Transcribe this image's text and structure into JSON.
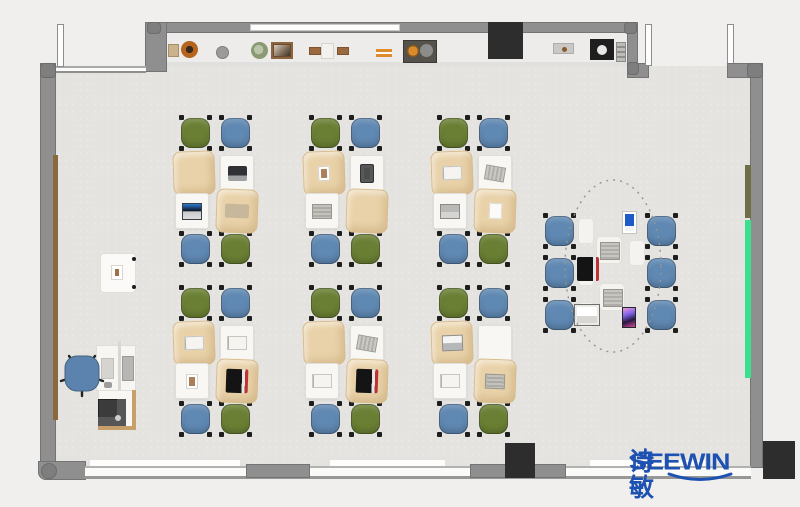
{
  "brand": {
    "name": "SEEWIN",
    "cjk": "诗敏",
    "color": "#1d51b2"
  },
  "palette": {
    "bg": "#f0efed",
    "floor": "#e4e3e0",
    "alcove": "#edecea",
    "wall": "#8f8f8f",
    "wallDark": "#747474",
    "column": "#2d2d2d",
    "tan": "#e9d2a9",
    "tanDark": "#d7bb8c",
    "deskWhite": "#f8f7f4",
    "deskBorder": "#e0ded8",
    "green": "#6a7f33",
    "blue": "#5f88b2",
    "foot": "#1e1e1e",
    "wood": "#8a6a3c",
    "olive": "#6e6e49",
    "neon": "#3ce08c",
    "pad": "#f4f3f0",
    "brand": "#1d51b2"
  },
  "classroom": {
    "cluster_chair_layout": [
      {
        "dx": 6,
        "dy": 0,
        "color": "green"
      },
      {
        "dx": 46,
        "dy": 0,
        "color": "blue"
      },
      {
        "dx": 6,
        "dy": 116,
        "color": "blue"
      },
      {
        "dx": 46,
        "dy": 116,
        "color": "green"
      }
    ],
    "cluster_desk_layout": [
      {
        "key": "t1",
        "kind": "tan",
        "dx": 0,
        "dy": 36,
        "rot": -2
      },
      {
        "key": "w1",
        "kind": "white",
        "dx": 47,
        "dy": 40,
        "rot": 0
      },
      {
        "key": "w2",
        "kind": "white",
        "dx": 2,
        "dy": 78,
        "rot": 0
      },
      {
        "key": "t2",
        "kind": "tan",
        "dx": 43,
        "dy": 74,
        "rot": 2
      }
    ],
    "clusters": [
      {
        "x": 173,
        "y": 115,
        "items": {
          "t1": "none",
          "w1": "laptop-dark",
          "w2": "laptop-open",
          "t2": "sketch"
        }
      },
      {
        "x": 303,
        "y": 115,
        "items": {
          "t1": "photo",
          "w1": "tablet-dark",
          "w2": "book-gray",
          "t2": "none"
        }
      },
      {
        "x": 431,
        "y": 115,
        "items": {
          "t1": "book-open",
          "w1": "notebook-striped",
          "w2": "laptop-gray",
          "t2": "paper"
        }
      },
      {
        "x": 173,
        "y": 285,
        "items": {
          "t1": "book-open",
          "w1": "book-open",
          "w2": "photo",
          "t2": "laptop-black"
        }
      },
      {
        "x": 303,
        "y": 285,
        "items": {
          "t1": "none",
          "w1": "notebook-striped",
          "w2": "book-open",
          "t2": "laptop-black"
        }
      },
      {
        "x": 431,
        "y": 285,
        "items": {
          "t1": "laptop-silver",
          "w1": "none",
          "w2": "book-open",
          "t2": "book-gray"
        }
      }
    ]
  },
  "collab_zone": {
    "chairs": [
      {
        "x": 543,
        "y": 213
      },
      {
        "x": 543,
        "y": 255
      },
      {
        "x": 543,
        "y": 297
      },
      {
        "x": 645,
        "y": 213
      },
      {
        "x": 645,
        "y": 255
      },
      {
        "x": 645,
        "y": 297
      }
    ],
    "side_pads": [
      {
        "x": 578,
        "y": 218
      },
      {
        "x": 578,
        "y": 260
      },
      {
        "x": 578,
        "y": 302
      },
      {
        "x": 629,
        "y": 240
      }
    ],
    "devices": [
      {
        "type": "tablet-blue",
        "x": 622,
        "y": 211
      },
      {
        "type": "pad-book",
        "x": 596,
        "y": 236
      },
      {
        "type": "laptop-black",
        "x": 577,
        "y": 257
      },
      {
        "type": "pad-book",
        "x": 599,
        "y": 283
      },
      {
        "type": "laptop-white",
        "x": 574,
        "y": 304
      },
      {
        "type": "tablet-pink",
        "x": 622,
        "y": 307
      }
    ]
  },
  "shelf_items": [
    {
      "type": "box-tan",
      "x": 168,
      "y": 44,
      "w": 11,
      "h": 13
    },
    {
      "type": "pot-orange",
      "x": 181,
      "y": 41,
      "w": 17,
      "h": 17
    },
    {
      "type": "disc-gray",
      "x": 216,
      "y": 46,
      "w": 13,
      "h": 13
    },
    {
      "type": "plant-green",
      "x": 251,
      "y": 42,
      "w": 17,
      "h": 17
    },
    {
      "type": "frame-photo",
      "x": 271,
      "y": 42,
      "w": 22,
      "h": 17
    },
    {
      "type": "box-brown",
      "x": 309,
      "y": 47,
      "w": 12,
      "h": 8
    },
    {
      "type": "box-white",
      "x": 321,
      "y": 43,
      "w": 13,
      "h": 16
    },
    {
      "type": "box-brown",
      "x": 337,
      "y": 47,
      "w": 12,
      "h": 8
    },
    {
      "type": "books-orange",
      "x": 376,
      "y": 49,
      "w": 16,
      "h": 8
    },
    {
      "type": "tray-dark",
      "x": 403,
      "y": 40,
      "w": 34,
      "h": 23
    },
    {
      "type": "tray-gray",
      "x": 553,
      "y": 43,
      "w": 21,
      "h": 11
    },
    {
      "type": "appliance-dark",
      "x": 590,
      "y": 39,
      "w": 24,
      "h": 21
    },
    {
      "type": "ladder",
      "x": 616,
      "y": 42,
      "w": 10,
      "h": 20
    }
  ],
  "columns": [
    {
      "x": 488,
      "y": 22,
      "w": 35,
      "h": 37
    },
    {
      "x": 505,
      "y": 443,
      "w": 30,
      "h": 35
    },
    {
      "x": 763,
      "y": 441,
      "w": 32,
      "h": 38
    }
  ]
}
